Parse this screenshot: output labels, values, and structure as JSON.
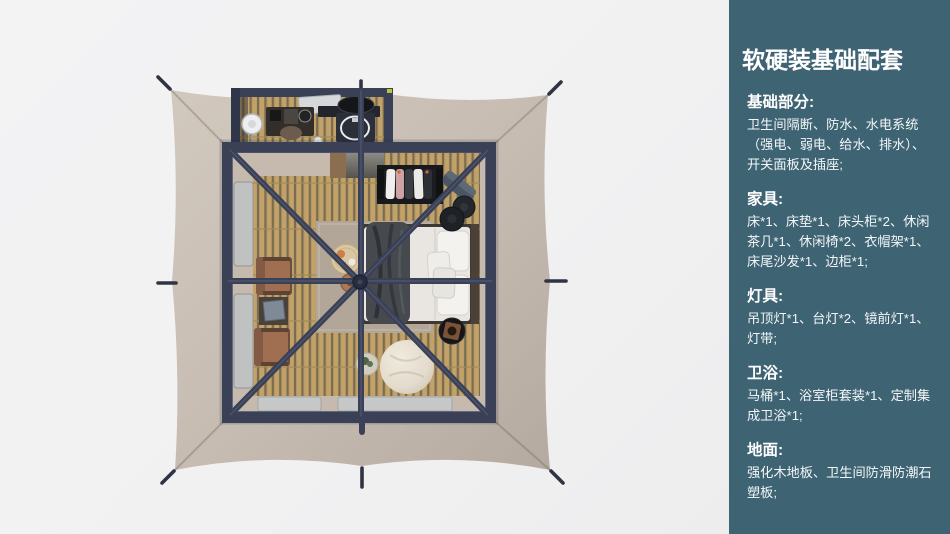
{
  "palette": {
    "page_bg": "#f1f1f2",
    "sidebar_bg": "#3e6373",
    "sidebar_text": "#ffffff",
    "tent_canvas": "#c6bbb1",
    "frame": "#3a4156",
    "wood": "#c3a269",
    "rug": "#b1a698",
    "bedding": "#e9e6e1"
  },
  "sidebar": {
    "title": "软硬装基础配套",
    "sections": [
      {
        "heading": "基础部分:",
        "body": "卫生间隔断、防水、水电系统\n（强电、弱电、给水、排水）、\n开关面板及插座;"
      },
      {
        "heading": "家具:",
        "body": "床*1、床垫*1、床头柜*2、休闲\n茶几*1、休闲椅*2、衣帽架*1、\n床尾沙发*1、边柜*1;"
      },
      {
        "heading": "灯具:",
        "body": "吊顶灯*1、台灯*2、镜前灯*1、\n灯带;"
      },
      {
        "heading": "卫浴:",
        "body": "马桶*1、浴室柜套装*1、定制集\n成卫浴*1;"
      },
      {
        "heading": "地面:",
        "body": "强化木地板、卫生间防滑防潮石\n塑板;"
      }
    ]
  },
  "scene": {
    "kind": "top-down 3D rendering",
    "subject": "tent guest room layout",
    "visible_items": [
      "tent canvas with corner and mid-edge guy stakes",
      "dark steel frame room with X roof beams and center hub",
      "bathroom annex with vanity sink, round mirror, desk and fan",
      "double bed with white bedding, dark throw and pillows",
      "clothes rack with hanging garments",
      "two leather lounge chairs with shelf",
      "bean bag pouf",
      "round side tables",
      "black ottomans",
      "area rug with breakfast tray",
      "wood plank flooring",
      "ground windows"
    ]
  }
}
